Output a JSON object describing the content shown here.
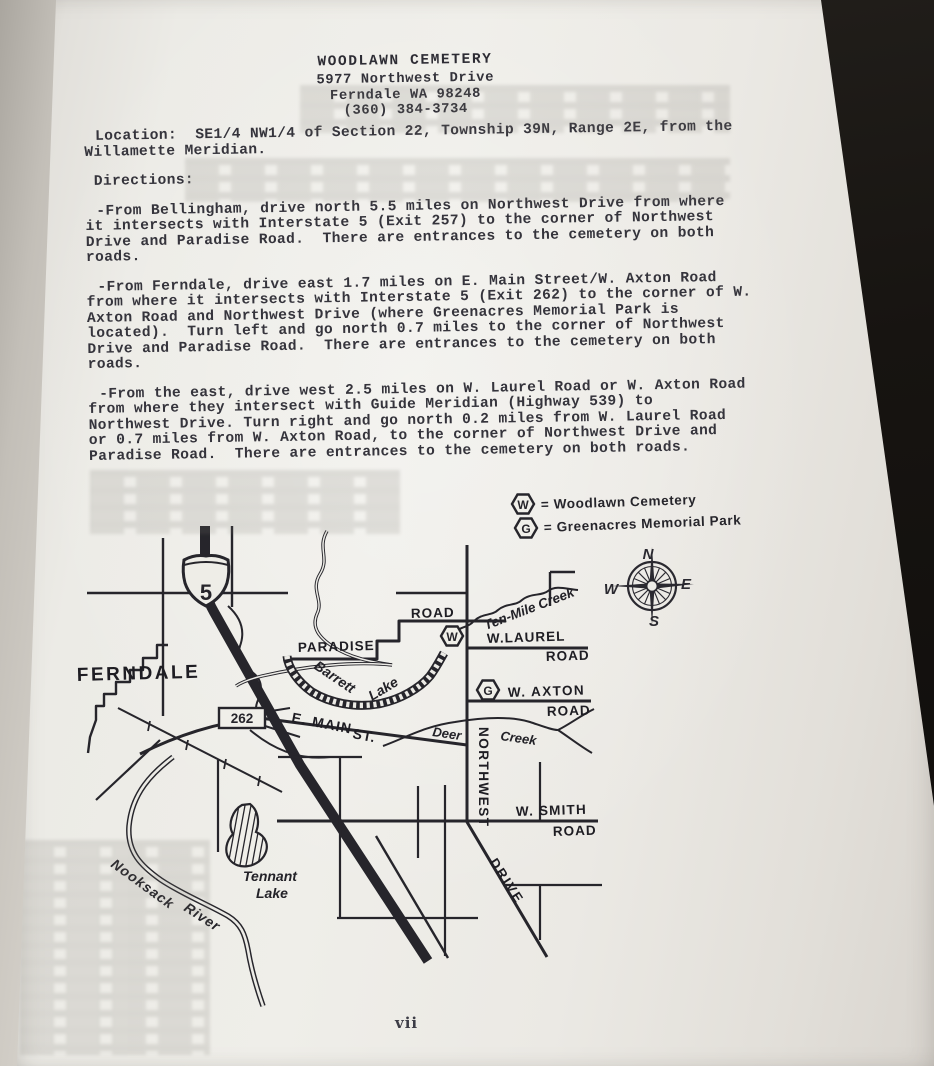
{
  "page": {
    "header": {
      "title": "WOODLAWN CEMETERY",
      "address": "5977 Northwest Drive",
      "city": "Ferndale WA 98248",
      "phone": "(360) 384-3734"
    },
    "location": {
      "lines": [
        "Location:  SE1/4 NW1/4 of Section 22, Township 39N, Range 2E, from the",
        "Willamette Meridian."
      ]
    },
    "directions_heading": "Directions:",
    "directions": [
      {
        "lines": [
          "-From Bellingham, drive north 5.5 miles on Northwest Drive from where",
          "it intersects with Interstate 5 (Exit 257) to the corner of Northwest",
          "Drive and Paradise Road.  There are entrances to the cemetery on both",
          "roads."
        ]
      },
      {
        "lines": [
          "-From Ferndale, drive east 1.7 miles on E. Main Street/W. Axton Road",
          "from where it intersects with Interstate 5 (Exit 262) to the corner of W.",
          "Axton Road and Northwest Drive (where Greenacres Memorial Park is",
          "located).  Turn left and go north 0.7 miles to the corner of Northwest",
          "Drive and Paradise Road.  There are entrances to the cemetery on both",
          "roads."
        ]
      },
      {
        "lines": [
          "-From the east, drive west 2.5 miles on W. Laurel Road or W. Axton Road",
          "from where they intersect with Guide Meridian (Highway 539) to",
          "Northwest Drive. Turn right and go north 0.2 miles from W. Laurel Road",
          "or 0.7 miles from W. Axton Road, to the corner of Northwest Drive and",
          "Paradise Road.  There are entrances to the cemetery on both roads."
        ]
      }
    ],
    "page_number": "vii"
  },
  "legend": {
    "items": [
      {
        "symbol": "W",
        "label": "= Woodlawn Cemetery"
      },
      {
        "symbol": "G",
        "label": "= Greenacres Memorial Park"
      }
    ]
  },
  "map": {
    "town": "FERNDALE",
    "interstate_shield": "5",
    "exit_box": "262",
    "roads": {
      "paradise": "PARADISE",
      "paradise_road": "ROAD",
      "w_laurel": "W.LAUREL",
      "w_laurel_road": "ROAD",
      "w_axton": "W. AXTON",
      "w_axton_road": "ROAD",
      "e_main": "E. MAIN",
      "e_main_st": "ST.",
      "w_smith": "W. SMITH",
      "w_smith_road": "ROAD",
      "northwest": "NORTHWEST",
      "drive": "DRIVE"
    },
    "water": {
      "ten_mile_creek": "Ten-Mile Creek",
      "barrett": "Barrett",
      "barrett_lake": "Lake",
      "deer": "Deer",
      "deer_creek": "Creek",
      "tennant": "Tennant",
      "tennant_lake": "Lake",
      "nooksack": "Nooksack",
      "nooksack_river": "River"
    },
    "compass": {
      "n": "N",
      "e": "E",
      "s": "S",
      "w": "W"
    },
    "markers": {
      "woodlawn": "W",
      "greenacres": "G"
    }
  },
  "colors": {
    "ink": "#232228",
    "page": "#ecebe6",
    "background": "#171411"
  }
}
